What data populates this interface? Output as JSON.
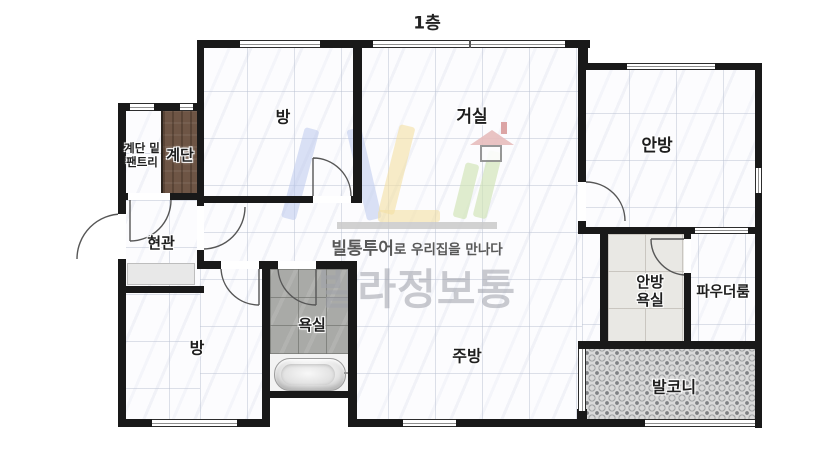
{
  "title": "1층",
  "watermark": {
    "brand_bold": "빌통투어",
    "brand_rest": "로 우리집을 만나다",
    "brand_name": "빌라정보통"
  },
  "rooms": {
    "bedroom_top": "방",
    "living": "거실",
    "master_bedroom": "안방",
    "pantry": "계단 밑\n팬트리",
    "stairs": "계단",
    "entrance": "현관",
    "bedroom_bottom": "방",
    "bathroom": "욕실",
    "kitchen": "주방",
    "master_bathroom": "안방\n욕실",
    "powder_room": "파우더룸",
    "balcony": "발코니"
  },
  "colors": {
    "wall": "#191919",
    "stairs_wood": "#6e5545",
    "bath_tile": "#a9aaa7",
    "master_bath_tile": "#e9e8e4",
    "balcony_floor": "#d9d9d9",
    "logo_blue": "#bcc8ec",
    "logo_yellow": "#f4dfa2",
    "logo_green": "#cfe3b3",
    "logo_red": "#e7bcbc",
    "watermark_text": "#9fa1aa"
  }
}
